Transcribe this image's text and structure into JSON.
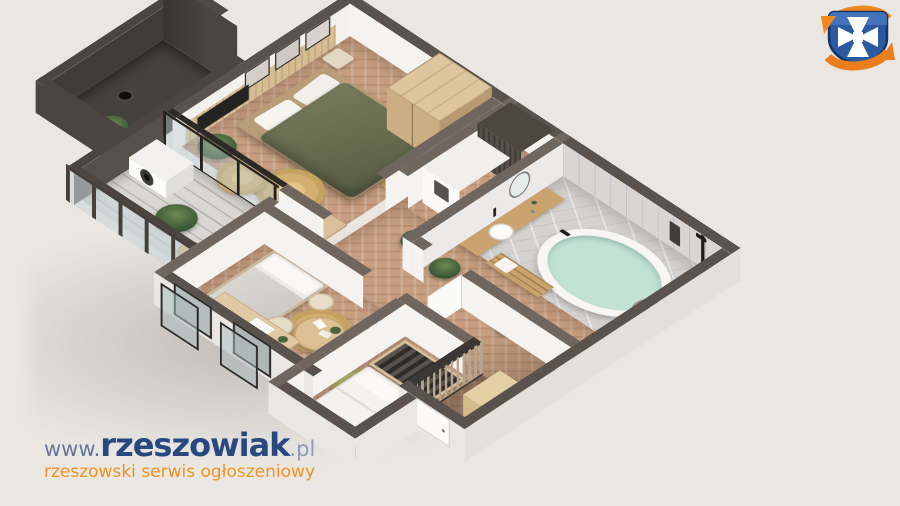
{
  "watermark": {
    "url_prefix": "www.",
    "brand": "rzeszowiak",
    "domain_suffix": ".pl",
    "tagline": "rzeszowski serwis ogłoszeniowy"
  },
  "logo": {
    "icon": "rzeszow-crest-shield-with-orange-circular-arrows"
  },
  "colors": {
    "background": "#eae7e3",
    "brand-navy": "#27497f",
    "brand-muted": "#64779b",
    "brand-suffix": "#8e9cb4",
    "accent-orange": "#f2921e",
    "logo-blue": "#2c5aa0",
    "logo-blue-dark": "#173367",
    "logo-orange": "#f0881e",
    "wall-cap": "#5a524c",
    "floor-wood": "#c79e80",
    "floor-marble": "#d4d2d0",
    "duvet-olive": "#6d7254"
  }
}
